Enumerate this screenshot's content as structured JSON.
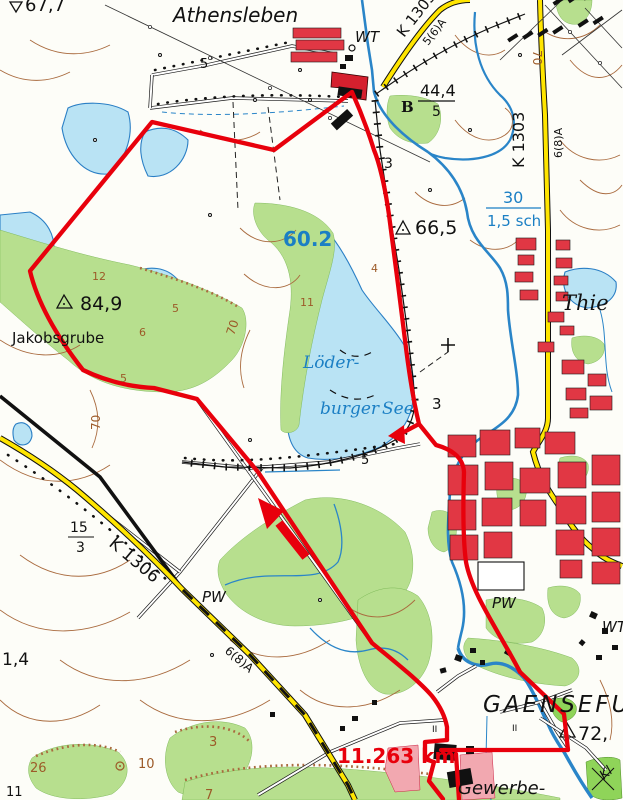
{
  "title": "Topographic map excerpt with GPS track loop (Athensleben / Löderburger See / Gaensefurth)",
  "colors": {
    "route_red": "#e8000c",
    "water_fill": "#b9e3f4",
    "water_line": "#2a7fc5",
    "forest_green": "#b7df8e",
    "urban_red": "#e13744",
    "road_yellow": "#ffe500",
    "contour_brown": "#a96a3e",
    "water_label_blue": "#1b7fc4"
  },
  "route": {
    "distance": "11.263 km"
  },
  "labels": {
    "athensleben": "Athensleben",
    "wt_top": "WT",
    "wt_right": "WT",
    "pw_center": "PW",
    "pw_right": "PW",
    "jakobsgrube": "Jakobsgrube",
    "lake_line1": "Löder-",
    "lake_line2": "burger",
    "lake_line3": "See",
    "thie": "Thie",
    "gaensefurth": "GAENSEFURTH",
    "gewerbe": "Gewerbe-",
    "kl": "Kl",
    "elev_677": "67,7",
    "elev_444": "44,4",
    "elev_444_sub": "5",
    "elev_665": "66,5",
    "elev_849": "84,9",
    "elev_72": "72,",
    "spot_602": "60.2",
    "spot_14": "1,4",
    "ford_width": "30",
    "ford_depth": "1,5 sch",
    "k1303_diag": "K 1303",
    "k1303_vert": "K 1303",
    "r56a": "5(6)A",
    "r68a_vert": "6(8)A",
    "r68a_sw": "6(8)A",
    "k1306": "K 1306",
    "n5_top": "5",
    "n5_south": "5",
    "n3_rail": "3",
    "n3_east": "3",
    "frac15": "15",
    "frac3": "3",
    "c70a": "70",
    "c70b": "70",
    "c70c": "70",
    "c4": "4",
    "c11": "11",
    "c6": "6",
    "c5a": "5",
    "c5b": "5",
    "c12": "12",
    "c26": "26",
    "c3": "3",
    "c10": "10",
    "c7": "7",
    "n11_corner": "11",
    "b_river": "B",
    "ii_a": "II",
    "ii_b": "II"
  }
}
